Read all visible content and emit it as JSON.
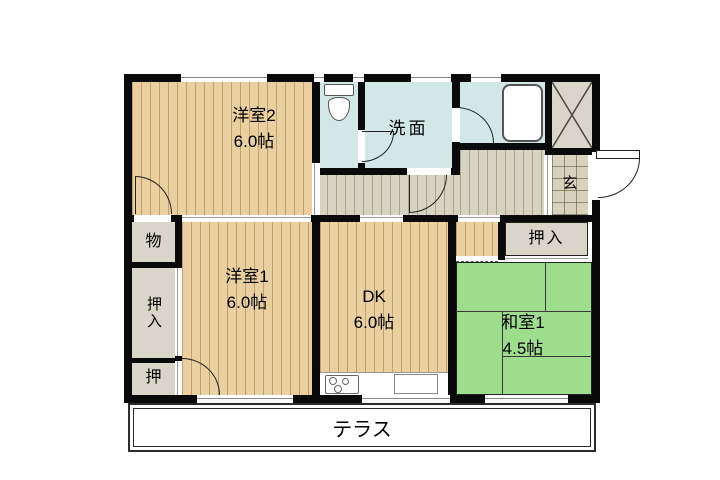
{
  "rooms": {
    "yoshitsu2": {
      "label": "洋室2",
      "size": "6.0帖"
    },
    "yoshitsu1": {
      "label": "洋室1",
      "size": "6.0帖"
    },
    "dk": {
      "label": "DK",
      "size": "6.0帖"
    },
    "washitsu1": {
      "label": "和室1",
      "size": "4.5帖"
    },
    "senmen": {
      "label": "洗面"
    },
    "genkan": {
      "label": "玄"
    },
    "mono": {
      "label": "物"
    },
    "oshiire_west": {
      "label": "押入"
    },
    "oshi": {
      "label": "押"
    },
    "oshiire_tatami": {
      "label": "押入"
    },
    "terrace": {
      "label": "テラス"
    }
  },
  "fixtures": {
    "toilet": "toilet-icon",
    "bathtub": "bathtub-icon",
    "stove": "stove-burners-icon",
    "sink": "kitchen-sink-icon",
    "storage_cross": "storage-x-icon"
  },
  "palette": {
    "wall": "#0a0a0a",
    "wood": "#eacfa0",
    "wood_line": "#c3a06a",
    "hall": "#d7d3c2",
    "hall_line": "#a9a596",
    "wet": "#d3e7e7",
    "tatami": "#9edc8e",
    "closet": "#d9d5c8",
    "tile": "#d8d2bc"
  }
}
